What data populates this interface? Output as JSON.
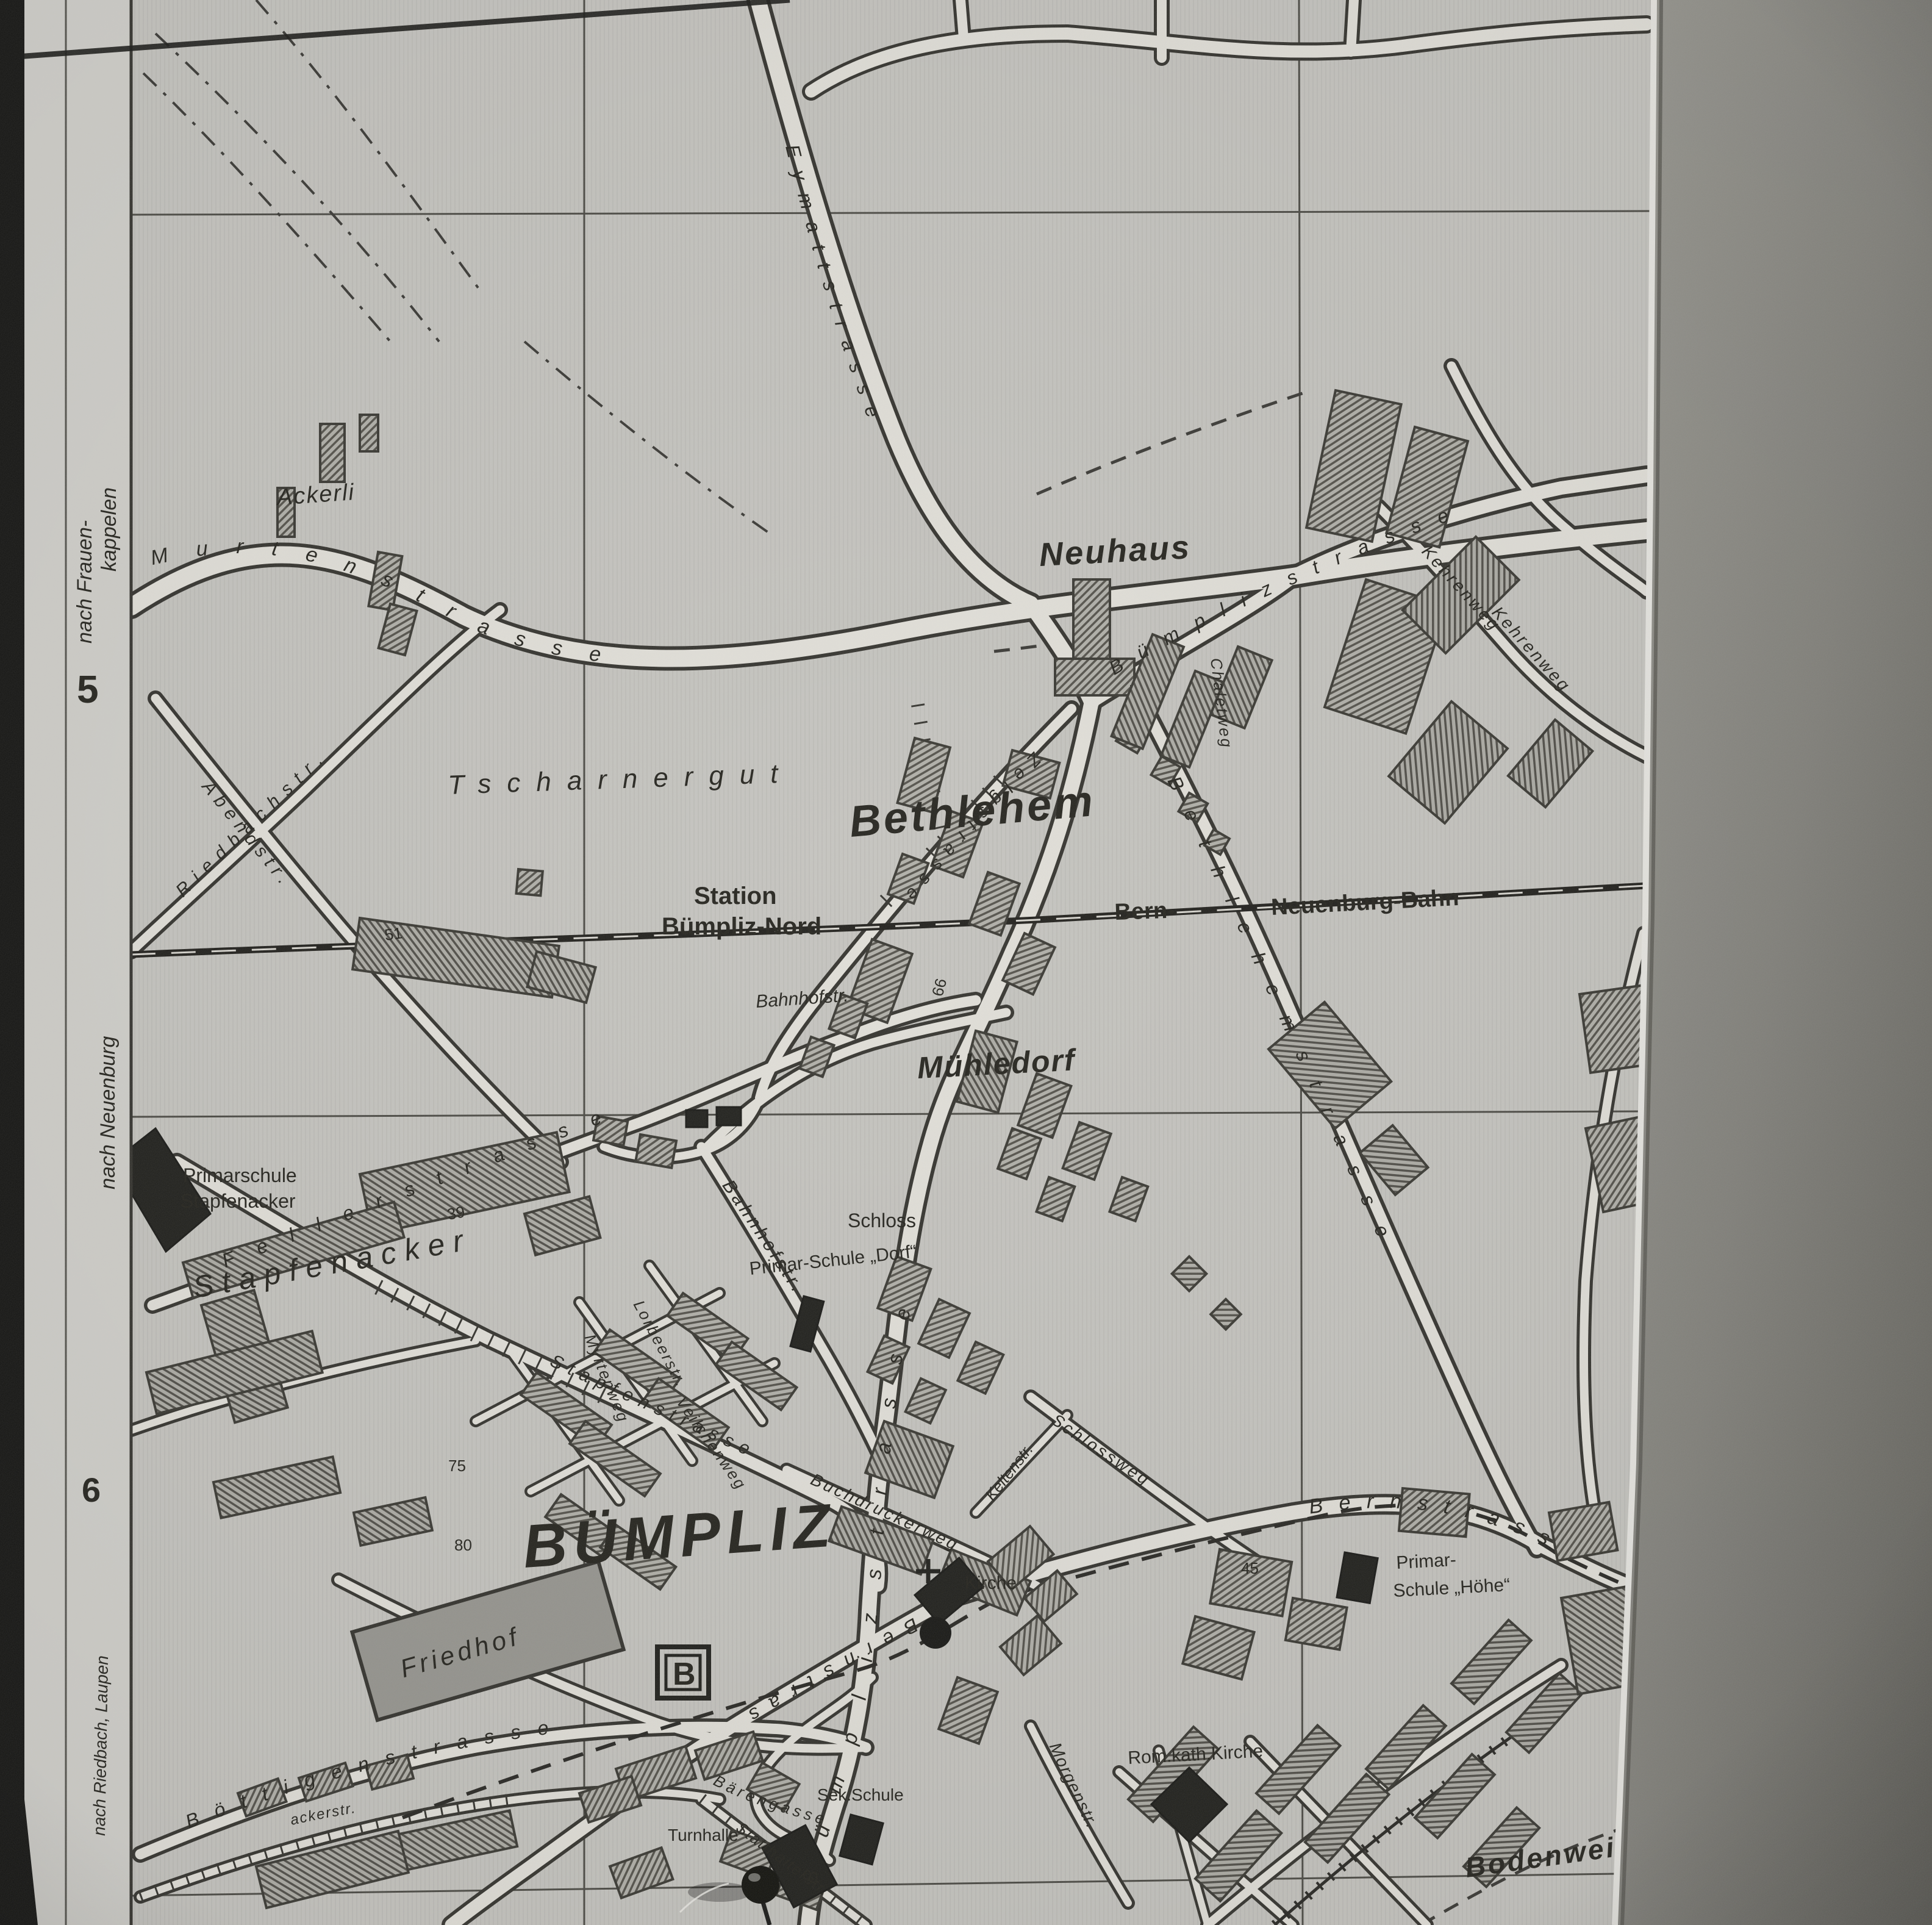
{
  "photo": {
    "background_gray": "#8b8a84",
    "film_edge_black": "#141412",
    "paper_tone": "#c7c6c1",
    "ink": "#2b2a25"
  },
  "margin": {
    "direction_frauenkappelen_line1": "nach Frauen-",
    "direction_frauenkappelen_line2": "kappelen",
    "grid_row_5": "5",
    "direction_neuenburg": "nach Neuenburg",
    "grid_row_6": "6",
    "direction_riedbach_laupen": "nach Riedbach, Laupen"
  },
  "places": {
    "bumpliz": "BÜMPLIZ",
    "bethlehem": "Bethlehem",
    "neuhaus": "Neuhaus",
    "muehledorf": "Mühledorf",
    "tscharnergut": "Tscharnergut",
    "stapfenacker": "Stapfenacker",
    "ackerli": "Ackerli",
    "bodenweid": "Bodenweid"
  },
  "railway": {
    "bern": "Bern-",
    "neuenburg_bahn": "Neuenburg-Bahn"
  },
  "station": {
    "line1": "Station",
    "line2": "Bümpliz-Nord"
  },
  "pois": {
    "schloss": "Schloss",
    "schule_dorf": "Primar-Schule „Dorf“",
    "primarschule_line1": "Primarschule",
    "primarschule_line2": "Stapfenacker",
    "schule_hoehe_line1": "Primar-",
    "schule_hoehe_line2": "Schule „Höhe“",
    "kirche": "Kirche",
    "rom_kath_kirche": "Rom.kath.Kirche",
    "friedhof": "Friedhof",
    "turnhalle": "Turnhalle",
    "sek_schule": "Sek.Schule"
  },
  "symbols": {
    "tram_stop_b": "B"
  },
  "streets": {
    "murten": "Murtenstrasse",
    "eymatt": "Eymattstrasse",
    "bumpliz_ne": "Bümplizstrasse",
    "bumpliz_s": "Bümplizstrasse",
    "bethlehemstr": "Bethlehemstrasse",
    "zelg": "Zelgstrasse",
    "feller": "Fellerstrasse",
    "bahnhof1": "Bahnhofstr.",
    "bahnhof2": "Bahnhofstr.",
    "riedbach": "Riedbachstr.",
    "abend": "Abendstr.",
    "kehren1": "Kehrenweg",
    "kehren2": "Kehrenweg",
    "chalet": "Chaletweg",
    "stapfenstr": "Stapfenstrasse",
    "myrten": "Myrtenweg",
    "lorbeer": "Lorbeerstr.",
    "veilchen": "Veilchenweg",
    "buchdrucker": "Buchdruckerweg",
    "kelten": "Keltenstr.",
    "schlossweg": "Schlossweg",
    "bern_e": "Bernstrasse",
    "bern_sw": "Bernstrasse",
    "bottigen": "Böttigenstrasse",
    "baeren": "Bärengasse",
    "statthalter": "Statthalterstr.",
    "morgen": "Morgenstr.",
    "acker_fragment": "ackerstr."
  },
  "house_numbers": {
    "n39": "39",
    "n51": "51",
    "n66": "66",
    "n75": "75",
    "n80": "80",
    "n45": "45"
  }
}
